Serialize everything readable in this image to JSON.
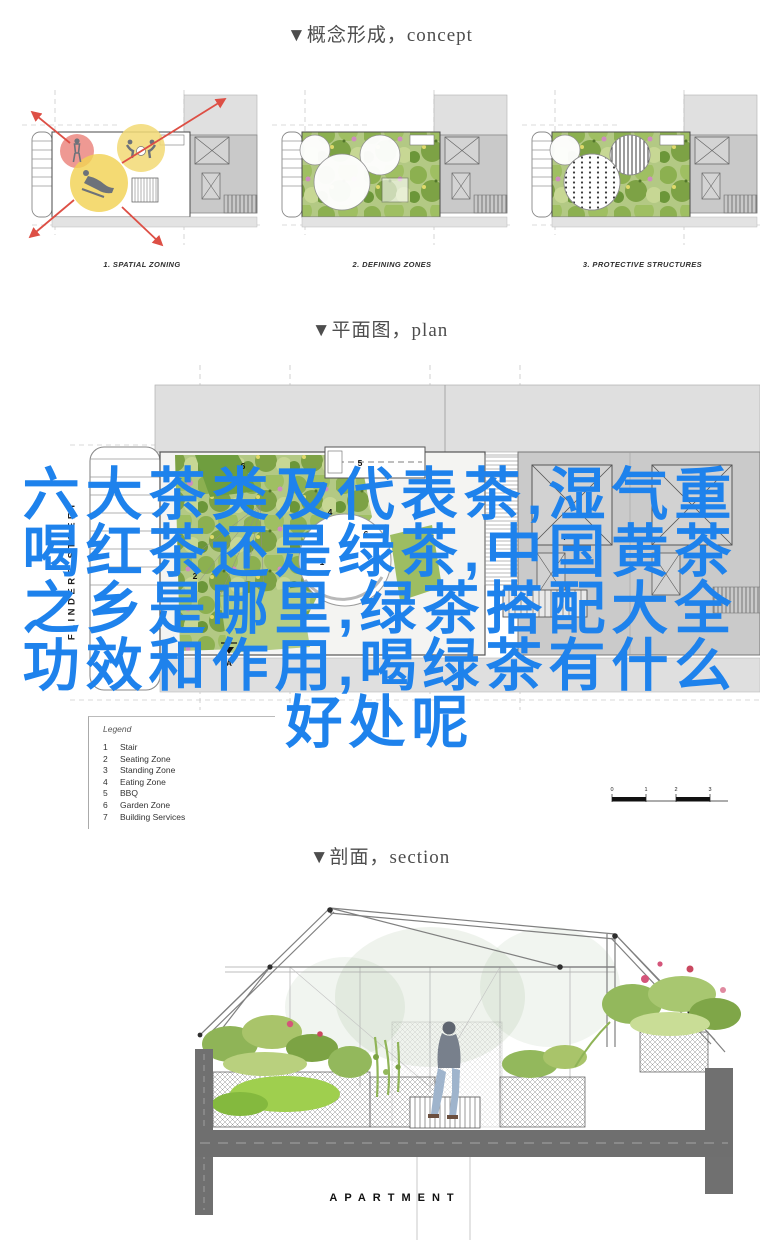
{
  "headers": {
    "concept": "▼概念形成，concept",
    "plan": "▼平面图，plan",
    "section": "▼剖面，section"
  },
  "concept_diagrams": {
    "captions": [
      "1. SPATIAL ZONING",
      "2. DEFINING ZONES",
      "3. PROTECTIVE STRUCTURES"
    ]
  },
  "plan": {
    "street_label": "FLINDERS STREET",
    "legend_title": "Legend",
    "legend_items": [
      {
        "num": "1",
        "label": "Stair"
      },
      {
        "num": "2",
        "label": "Seating Zone"
      },
      {
        "num": "3",
        "label": "Standing Zone"
      },
      {
        "num": "4",
        "label": "Eating Zone"
      },
      {
        "num": "5",
        "label": "BBQ"
      },
      {
        "num": "6",
        "label": "Garden Zone"
      },
      {
        "num": "7",
        "label": "Building Services"
      }
    ],
    "zone_markers": {
      "garden": "6",
      "bbq": "5",
      "eating": "4",
      "stair": "1",
      "seating": "2",
      "garden2": "6",
      "services": "7"
    },
    "section_marker": "A",
    "scale_ticks": [
      "0",
      "1",
      "2",
      "3"
    ]
  },
  "overlay_text": {
    "color": "#1e82ec",
    "lines": [
      "六大茶类及代表茶,湿气重",
      "喝红茶还是绿茶,中国黄茶",
      "之乡是哪里,绿茶搭配大全",
      "功效和作用,喝绿茶有什么",
      "好处呢"
    ]
  },
  "section_drawing": {
    "label": "APARTMENT"
  }
}
